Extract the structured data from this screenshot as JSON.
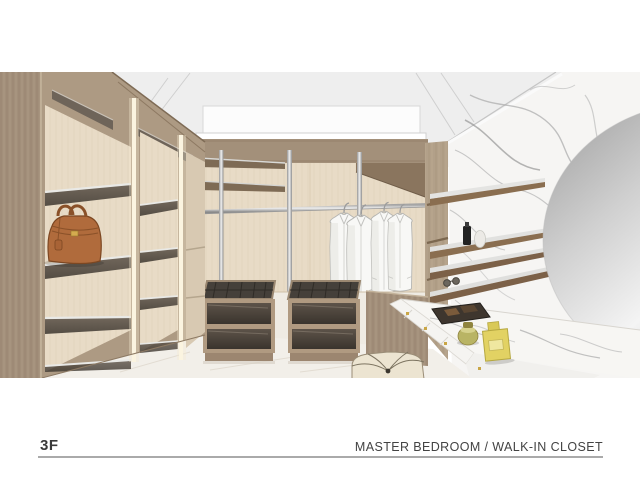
{
  "footer": {
    "floor_label": "3F",
    "title": "MASTER BEDROOM / WALK-IN CLOSET",
    "rule_color": "#aaaaaa",
    "text_color": "#3a3a3a"
  },
  "scene": {
    "description": "3D interior rendering of a master-bedroom walk-in closet",
    "objects": [
      "wood shelving wall with warm LED strips",
      "brown leather handbag on glass shelf",
      "ceiling recessed light panel",
      "chrome hanging rod and poles with four white shirts",
      "two wood island chests with dark glass drawer fronts",
      "white marble feature wall with floating shelves",
      "perfume bottles and sunglasses on shelves",
      "large oval silver mirror",
      "marble vanity counter with brass-knob drawers, tray, jar and gold perfume bottle",
      "cream tufted ottoman"
    ],
    "palette": {
      "wood": "#a89480",
      "wood_dark": "#8d7a66",
      "panel_beige": "#e8dbc6",
      "ceiling": "#eeeeee",
      "marble": "#f6f5f3",
      "marble_vein": "#a9a9a9",
      "chrome": "#cccccc",
      "led_warm": "#f8efd7",
      "bag_leather": "#b06b3c",
      "glass_dark": "#4e463e",
      "mirror_silver": "#c9c9c9",
      "gold_bottle": "#e2d263",
      "ottoman": "#ece4d1",
      "floor": "#f2efe9"
    }
  }
}
